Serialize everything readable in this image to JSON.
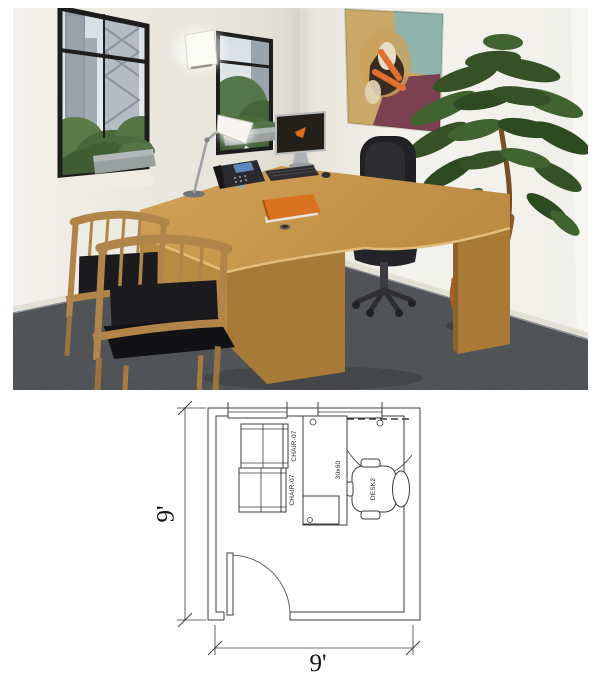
{
  "page": {
    "background": "#ffffff"
  },
  "render": {
    "description": "3d-office-room-rendering",
    "colors": {
      "wall": "#e9e6dd",
      "wall_bright": "#f3f2ec",
      "carpet": "#72767b",
      "window_frame": "#1d1d1d",
      "sky": "#dde6ea",
      "buildings": "#97a2aa",
      "foliage": "#4c6b3a",
      "plant_green": "#365127",
      "trunk_brown": "#8a5a2b",
      "pot_orange": "#c06b2c",
      "desk_wood": "#c89850",
      "desk_wood_dark": "#a87a38",
      "chair_wood": "#b1854a",
      "cushion_black": "#1b1b1e",
      "chair_black": "#212125",
      "book_orange": "#d9731f",
      "screen_logo_orange": "#e06a1e",
      "phone_screen_blue": "#5f87c0",
      "plan_line": "#3c3c3c"
    }
  },
  "floor_plan": {
    "dim_width": "9'",
    "dim_height": "9'",
    "labels": {
      "guest_chair_1": "CHAIR-07",
      "guest_chair_2": "CHAIR-07",
      "desk": "30x60",
      "task_chair": "DESK2"
    }
  }
}
